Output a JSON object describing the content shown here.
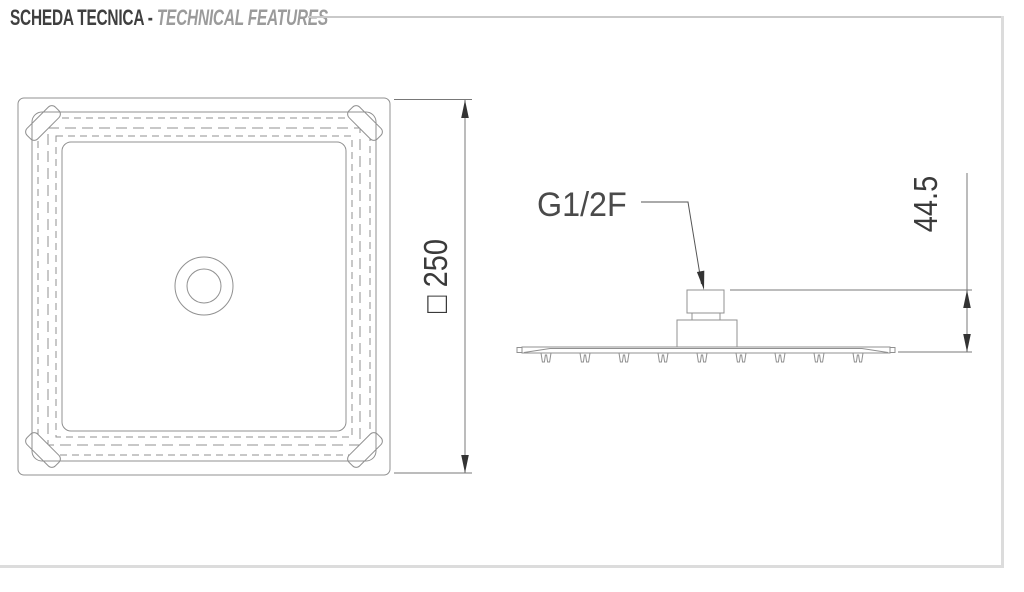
{
  "header": {
    "title_primary": "SCHEDA TECNICA -",
    "title_secondary": "TECHNICAL FEATURES"
  },
  "top_view": {
    "dimension_side": "□ 250"
  },
  "side_view": {
    "thread_label": "G1/2F",
    "dimension_height": "44.5"
  },
  "colors": {
    "background": "#ffffff",
    "drawing_line": "#909090",
    "dimension_line": "#787878",
    "dimension_text": "#3a3a3a",
    "arrow_fill": "#333333",
    "header_primary": "#3f3f3f",
    "header_secondary": "#9b9b9b",
    "header_rule": "#c9c9c9",
    "page_frame": "#dcdcdc"
  }
}
